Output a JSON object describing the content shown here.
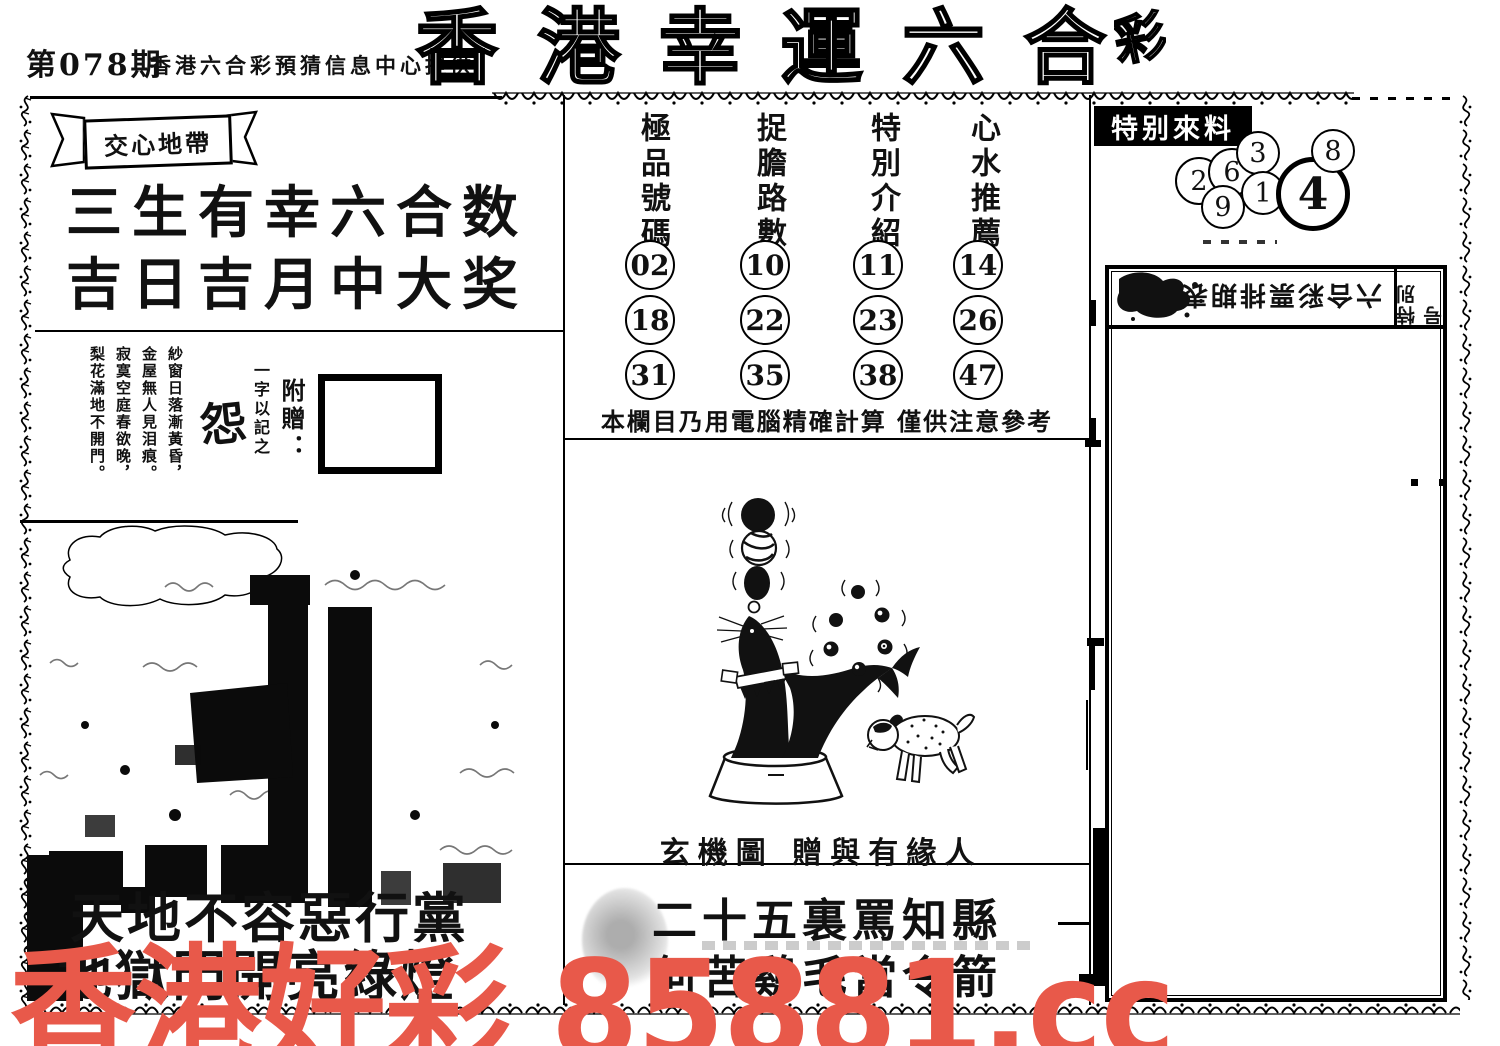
{
  "page": {
    "issue": "第078期",
    "provider": "香港六合彩預猜信息中心提供",
    "title": "香港幸運六合",
    "title_partial": "彩"
  },
  "left_panel": {
    "ribbon": "交心地帶",
    "slogan_line1": "三生有幸六合数",
    "slogan_line2": "吉日吉月中大奖",
    "poem_lines": [
      "紗窗日落漸黃昏，",
      "金屋無人見泪痕。",
      "寂寞空庭春欲晚，",
      "梨花滿地不開門。"
    ],
    "poem_note": "一字以記之",
    "poem_word": "怨",
    "gift_label": "附贈：",
    "bottom_line1": "天地不容惡行黨",
    "bottom_line2": "地獄門開亮綠燈"
  },
  "tips": {
    "columns": [
      {
        "title": "極品號碼",
        "numbers": [
          "02",
          "18",
          "31"
        ]
      },
      {
        "title": "捉膽路數",
        "numbers": [
          "10",
          "22",
          "35"
        ]
      },
      {
        "title": "特別介紹",
        "numbers": [
          "11",
          "23",
          "38"
        ]
      },
      {
        "title": "心水推薦",
        "numbers": [
          "14",
          "26",
          "47"
        ]
      }
    ],
    "note": "本欄目乃用電腦精確計算 僅供注意參考",
    "figure_caption": "玄機圖 贈與有緣人",
    "riddle_line1": "二十五裏罵知縣",
    "riddle_line2": "何苦鷄毛當令箭"
  },
  "special": {
    "label": "特别來料",
    "balls": [
      "2",
      "6",
      "3",
      "9",
      "1",
      "4",
      "8"
    ],
    "highlight_ball": "4"
  },
  "schedule": {
    "title": "六合彩票排期表",
    "side_label": "特別号"
  },
  "watermark": {
    "text": "香港好彩 85881.cc",
    "color": "#e8594a"
  }
}
